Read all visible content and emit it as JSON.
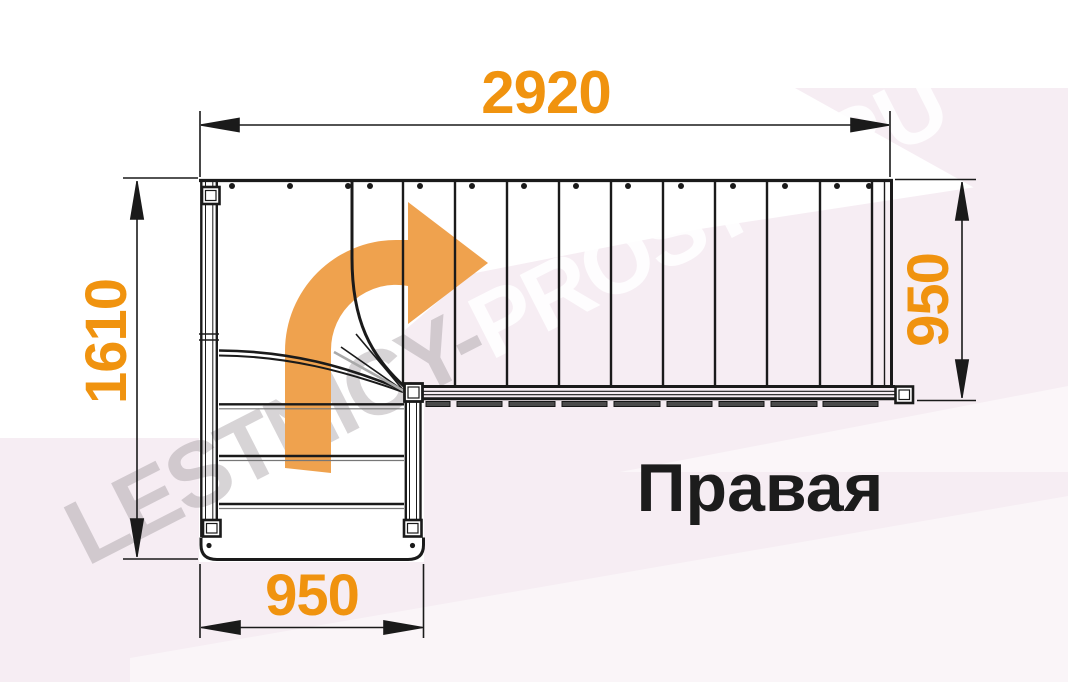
{
  "drawing": {
    "orientation_label": "Правая",
    "dimensions": {
      "top_width": "2920",
      "left_height": "1610",
      "right_height": "950",
      "bottom_width": "950"
    }
  },
  "watermark": {
    "segment_gray": "LESTNICY-",
    "segment_white": "PROSTO.RU"
  },
  "icons": {
    "direction_arrow": "curved-right-turn-arrow"
  },
  "colors": {
    "dimension_text": "#F0930F",
    "direction_arrow": "#EFA24E",
    "drawing_lines": "#1A1A1A",
    "background_tint": "#F6EDF3",
    "orientation_text": "#1C1C1C"
  }
}
